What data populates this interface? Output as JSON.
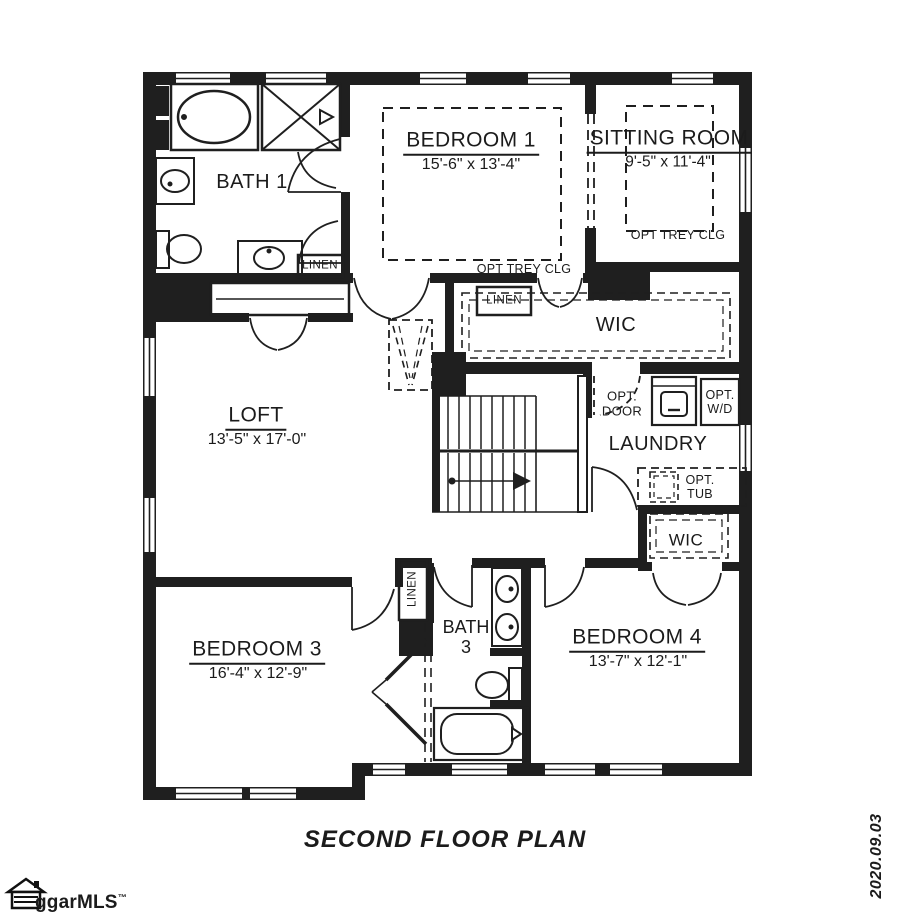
{
  "plan": {
    "rooms": {
      "bath1": {
        "name": "BATH 1"
      },
      "bedroom1": {
        "name": "BEDROOM 1",
        "dims": "15'-6\" x 13'-4\""
      },
      "sitting_room": {
        "name": "SITTING ROOM",
        "dims": "9'-5\" x 11'-4\""
      },
      "loft": {
        "name": "LOFT",
        "dims": "13'-5\" x 17'-0\""
      },
      "wic_master": {
        "name": "WIC"
      },
      "laundry": {
        "name": "LAUNDRY"
      },
      "wic_bedroom4": {
        "name": "WIC"
      },
      "bath3": {
        "name": "BATH\n3"
      },
      "bedroom3": {
        "name": "BEDROOM 3",
        "dims": "16'-4\" x 12'-9\""
      },
      "bedroom4": {
        "name": "BEDROOM 4",
        "dims": "13'-7\" x 12'-1\""
      }
    },
    "annotations": {
      "opt_trey_bedroom1": "OPT TREY CLG",
      "opt_trey_sitting": "OPT TREY CLG",
      "linen_bath1": "LINEN",
      "linen_hall": "LINEN",
      "linen_bath3": "LINEN",
      "opt_door": "OPT.\nDOOR",
      "opt_wd": "OPT.\nW/D",
      "opt_tub": "OPT.\nTUB"
    },
    "title": "SECOND FLOOR PLAN",
    "watermark": {
      "text": "ggarMLS",
      "tm": "™"
    },
    "date": "2020.09.03"
  }
}
